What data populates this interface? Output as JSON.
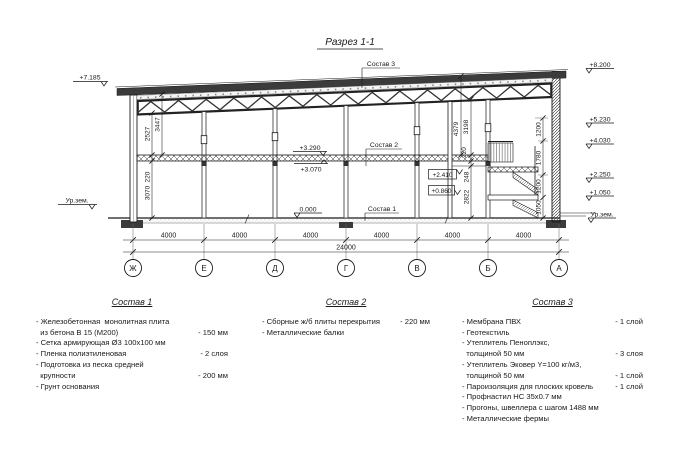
{
  "title": "Разрез 1-1",
  "colors": {
    "line": "#1a1a1a",
    "roof": "#3b3b3b",
    "hatch": "#444444"
  },
  "marks": {
    "left_top": "+7.185",
    "left_ground": "Ур.зем.",
    "right": [
      "+8.200",
      "+5.230",
      "+4.030",
      "+2.250",
      "+1.050",
      "Ур.зем."
    ],
    "floor_top": "+3.290",
    "floor_bot": "+3.070",
    "zero": "0.000",
    "stair_hi": "+2.410",
    "stair_lo": "+0.860"
  },
  "callouts": {
    "c1": "Состав 1",
    "c2": "Состав 2",
    "c3": "Состав 3"
  },
  "dims": {
    "left": [
      "2527",
      "3447",
      "220",
      "3070"
    ],
    "mid": [
      "4379",
      "3198",
      "220",
      "248",
      "2822"
    ],
    "stair": [
      "1200",
      "1780",
      "1200",
      "1050"
    ],
    "bays": [
      "4000",
      "4000",
      "4000",
      "4000",
      "4000",
      "4000"
    ],
    "total": "24000"
  },
  "axes": [
    "Ж",
    "Е",
    "Д",
    "Г",
    "В",
    "Б",
    "А"
  ],
  "comp1": {
    "title": "Состав 1",
    "lines": [
      {
        "t": "- Железобетонная  монолитная плита",
        "v": ""
      },
      {
        "t": "  из бетона В 15 (М200)",
        "v": "- 150 мм"
      },
      {
        "t": "- Сетка армирующая Ø3 100х100 мм",
        "v": ""
      },
      {
        "t": "- Пленка полиэтиленовая",
        "v": "- 2 слоя"
      },
      {
        "t": "- Подготовка из песка средней",
        "v": ""
      },
      {
        "t": "  крупности",
        "v": "- 200 мм"
      },
      {
        "t": "- Грунт основания",
        "v": ""
      }
    ]
  },
  "comp2": {
    "title": "Состав 2",
    "lines": [
      {
        "t": "- Сборные ж/б плиты перекрытия",
        "v": "- 220 мм"
      },
      {
        "t": "- Металлические балки",
        "v": ""
      }
    ]
  },
  "comp3": {
    "title": "Состав 3",
    "lines": [
      {
        "t": "- Мембрана ПВХ",
        "v": "- 1 слой"
      },
      {
        "t": "- Геотекстиль",
        "v": "- 1 слой"
      },
      {
        "t": "- Утеплитель Пеноплэкс,",
        "v": ""
      },
      {
        "t": "  толщиной 50 мм",
        "v": "- 3 слоя"
      },
      {
        "t": "- Утеплитель Эковер Y=100 кг/м3,",
        "v": ""
      },
      {
        "t": "  толщиной 50 мм",
        "v": "- 1 слой"
      },
      {
        "t": "- Пароизоляция для плоских кровель",
        "v": "- 1 слой"
      },
      {
        "t": "- Профнастил НС 35х0.7 мм",
        "v": ""
      },
      {
        "t": "- Прогоны, швеллера с шагом 1488 мм",
        "v": ""
      },
      {
        "t": "- Металлические фермы",
        "v": ""
      }
    ]
  }
}
